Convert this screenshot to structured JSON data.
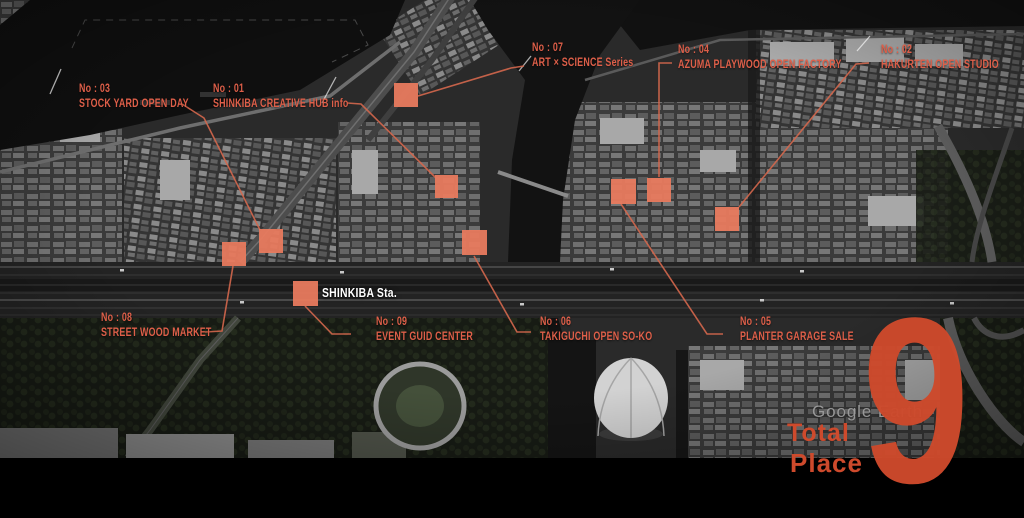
{
  "colors": {
    "marker": "#E87A5E",
    "leader": "#D4674C",
    "label_text": "#DE5F49",
    "accent": "#CE4A2C",
    "station_text": "#FFFFFF",
    "watermark": "#A0A0A0",
    "background": "#000000"
  },
  "station": {
    "label": "SHINKIBA Sta.",
    "x": 322,
    "y": 285
  },
  "places": [
    {
      "id": "01",
      "no": "No : 01",
      "name": "SHINKIBA CREATIVE HUB info",
      "label": {
        "x": 213,
        "y": 81
      },
      "marker": {
        "x": 435,
        "y": 175,
        "size": 23
      },
      "leader": [
        [
          347,
          103
        ],
        [
          361,
          104
        ],
        [
          436,
          178
        ]
      ]
    },
    {
      "id": "02",
      "no": "No : 02",
      "name": "HAKURTEN OPEN STUDIO",
      "label": {
        "x": 881,
        "y": 42
      },
      "marker": {
        "x": 715,
        "y": 207,
        "size": 24
      },
      "leader": [
        [
          869,
          63
        ],
        [
          856,
          64
        ],
        [
          739,
          207
        ]
      ]
    },
    {
      "id": "03",
      "no": "No : 03",
      "name": "STOCK YARD OPEN DAY",
      "label": {
        "x": 79,
        "y": 81
      },
      "marker": {
        "x": 259,
        "y": 229,
        "size": 24
      },
      "leader": [
        [
          182,
          104
        ],
        [
          204,
          118
        ],
        [
          260,
          230
        ]
      ]
    },
    {
      "id": "04",
      "no": "No : 04",
      "name": "AZUMA PLAYWOOD OPEN FACTORY",
      "label": {
        "x": 678,
        "y": 42
      },
      "marker": {
        "x": 647,
        "y": 178,
        "size": 24
      },
      "leader": [
        [
          672,
          63
        ],
        [
          659,
          63
        ],
        [
          659,
          177
        ]
      ]
    },
    {
      "id": "05",
      "no": "No : 05",
      "name": "PLANTER GARAGE SALE",
      "label": {
        "x": 740,
        "y": 314
      },
      "marker": {
        "x": 611,
        "y": 179,
        "size": 25
      },
      "leader": [
        [
          621,
          204
        ],
        [
          707,
          334
        ],
        [
          723,
          334
        ]
      ]
    },
    {
      "id": "06",
      "no": "No : 06",
      "name": "TAKIGUCHI OPEN SO-KO",
      "label": {
        "x": 540,
        "y": 314
      },
      "marker": {
        "x": 462,
        "y": 230,
        "size": 25
      },
      "leader": [
        [
          474,
          256
        ],
        [
          517,
          332
        ],
        [
          531,
          332
        ]
      ]
    },
    {
      "id": "07",
      "no": "No : 07",
      "name": "ART × SCIENCE Series",
      "label": {
        "x": 532,
        "y": 40
      },
      "marker": {
        "x": 394,
        "y": 83,
        "size": 24
      },
      "leader": [
        [
          418,
          96
        ],
        [
          511,
          68
        ],
        [
          524,
          66
        ]
      ]
    },
    {
      "id": "08",
      "no": "No : 08",
      "name": "STREET WOOD MARKET",
      "label": {
        "x": 101,
        "y": 310
      },
      "marker": {
        "x": 222,
        "y": 242,
        "size": 24
      },
      "leader": [
        [
          233,
          266
        ],
        [
          222,
          331
        ],
        [
          205,
          332
        ]
      ]
    },
    {
      "id": "09",
      "no": "No : 09",
      "name": "EVENT GUID CENTER",
      "label": {
        "x": 376,
        "y": 314
      },
      "marker": {
        "x": 293,
        "y": 281,
        "size": 25
      },
      "leader": [
        [
          305,
          306
        ],
        [
          332,
          334
        ],
        [
          351,
          334
        ]
      ]
    }
  ],
  "footer": {
    "count": "9",
    "watermark": "Google Earth",
    "line1": "Total",
    "line2": "Place"
  }
}
